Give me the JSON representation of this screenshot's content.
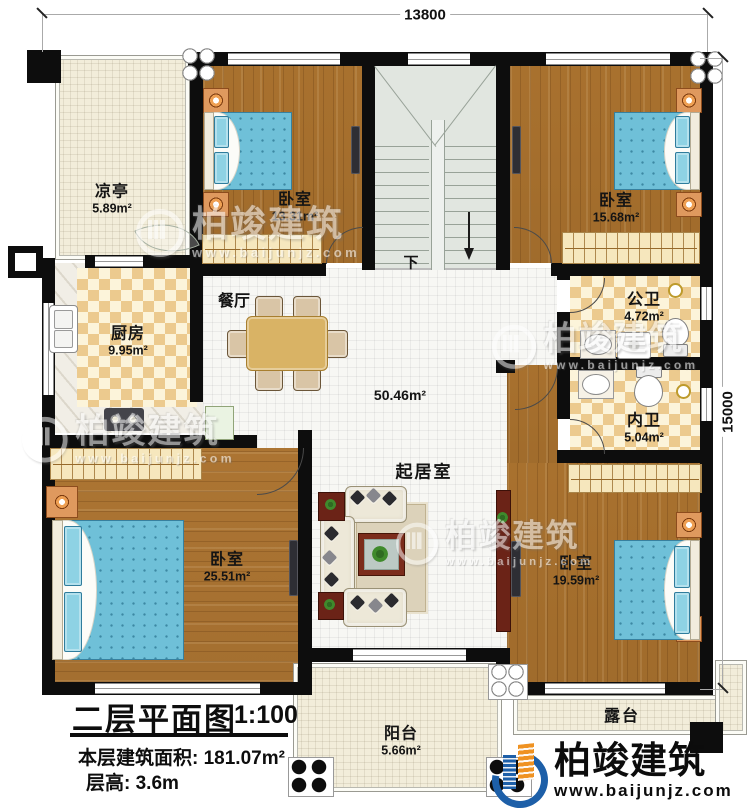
{
  "dimensions": {
    "top": "13800",
    "right": "15000"
  },
  "rooms": {
    "pavilion": {
      "name": "凉亭",
      "area": "5.89m²"
    },
    "bedroom_top_left": {
      "name": "卧室",
      "area": "13.31m²"
    },
    "bedroom_top_right": {
      "name": "卧室",
      "area": "15.68m²"
    },
    "kitchen": {
      "name": "厨房",
      "area": "9.95m²"
    },
    "dining": {
      "name": "餐厅"
    },
    "public_bath": {
      "name": "公卫",
      "area": "4.72m²"
    },
    "private_bath": {
      "name": "内卫",
      "area": "5.04m²"
    },
    "living": {
      "name": "起居室",
      "area": "50.46m²"
    },
    "bedroom_bottom_left": {
      "name": "卧室",
      "area": "25.51m²"
    },
    "bedroom_bottom_right": {
      "name": "卧室",
      "area": "19.59m²"
    },
    "balcony": {
      "name": "阳台",
      "area": "5.66m²"
    },
    "terrace": {
      "name": "露台"
    }
  },
  "stair": {
    "down": "下"
  },
  "title_block": {
    "title": "二层平面图",
    "scale": "1:100",
    "floor_area": "本层建筑面积: 181.07m²",
    "floor_height": "层高: 3.6m"
  },
  "brand": {
    "name": "柏竣建筑",
    "website": "www.baijunjz.com"
  },
  "watermark": {
    "name": "柏竣建筑",
    "website": "www.baijunjz.com"
  },
  "colors": {
    "wall": "#0d0d0d",
    "wood": "#ae7631",
    "cream": "#f2edda",
    "tile": "#f7f7f4",
    "checker": "#ecca8e",
    "bed_blue": "#6fc0d8",
    "brand_blue": "#1d5fa8",
    "brand_orange": "#ef9222"
  }
}
